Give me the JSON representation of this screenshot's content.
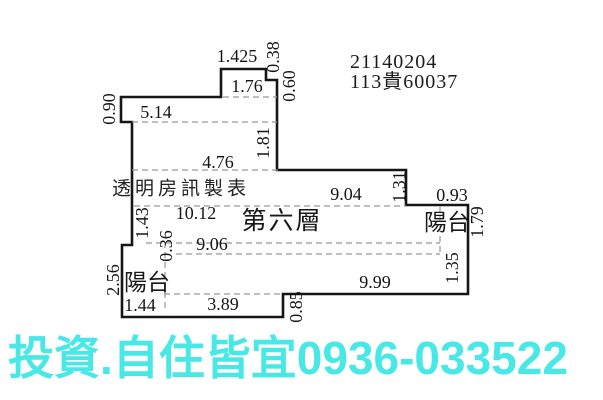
{
  "plan": {
    "ref_line1": "21140204",
    "ref_line2": "113貴60037",
    "watermark": "透明房訊製表",
    "floor_name": "第六層",
    "balcony_right": "陽台",
    "balcony_left": "陽台",
    "dims": {
      "top_width": "1.425",
      "top_right_step": "0.38",
      "top_inner_width": "1.76",
      "right_wall_upper": "0.60",
      "left_wall_upper": "0.90",
      "upper_room_width": "5.14",
      "right_wall_mid": "1.81",
      "mid_room_width": "4.76",
      "main_width_a": "9.04",
      "right_step_down": "1.31",
      "right_balcony_width": "0.93",
      "main_width_b": "10.12",
      "right_balcony_depth": "1.79",
      "left_wall_mid": "1.43",
      "offset_gap": "0.36",
      "lower_width": "9.06",
      "left_balcony_depth": "2.56",
      "bottom_seg_a": "1.44",
      "bottom_seg_b": "3.89",
      "bottom_step": "0.85",
      "bottom_width": "9.99",
      "right_wall_lower": "1.35"
    },
    "banner": "投資.自住皆宜0936-033522"
  },
  "colors": {
    "banner_text": "#48e8e6",
    "plan_lines": "#161616",
    "dimension_dashes": "#979797"
  }
}
